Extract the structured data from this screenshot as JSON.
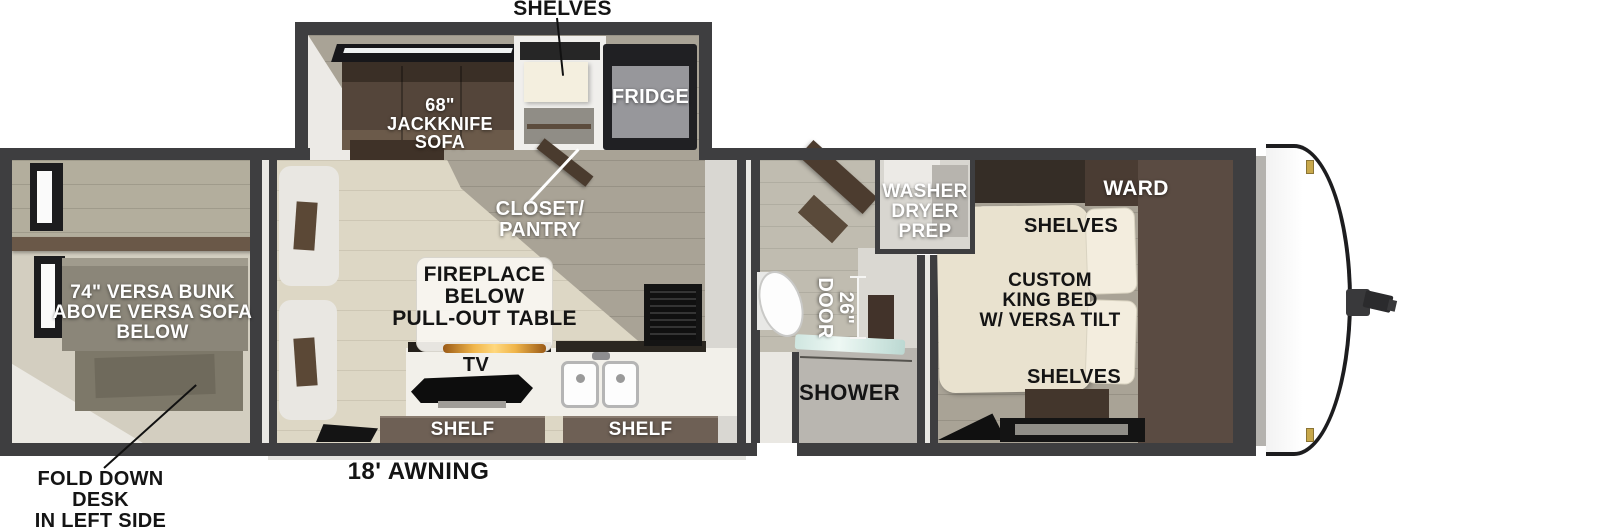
{
  "palette": {
    "wall": "#3e3e40",
    "floor_beige": "#ddd7c5",
    "floor_olive": "#a9a396",
    "sofa_brown": "#54453a",
    "ward_brown": "#5a4b42",
    "bed_cream": "#e9e2cf",
    "shelf_bar_brown": "#6e6055",
    "flame_orange": "#e09a36",
    "shower_glass_teal": "#cfe6e0",
    "marker_light_gold": "#c8a84b"
  },
  "floorplan": {
    "callouts": {
      "shelves_slideout": "SHELVES",
      "closet_pantry": "CLOSET/\nPANTRY",
      "fold_down_desk": "FOLD DOWN DESK\nIN LEFT SIDE\nREAR BED",
      "awning": "18' AWNING"
    },
    "slideout": {
      "sofa": "68\"\nJACKKNIFE\nSOFA",
      "fridge": "FRIDGE"
    },
    "rear_bedroom": {
      "bunk": "74\" VERSA BUNK\nABOVE VERSA SOFA\nBELOW"
    },
    "living_kitchen": {
      "fireplace_table": "FIREPLACE\nBELOW\nPULL-OUT TABLE",
      "tv": "TV",
      "shelf_left": "SHELF",
      "shelf_right": "SHELF"
    },
    "bathroom": {
      "washer_dryer_prep": "WASHER\nDRYER\nPREP",
      "door_width": "26\"\nDOOR",
      "shower": "SHOWER"
    },
    "front_bedroom": {
      "ward": "WARD",
      "shelves_top": "SHELVES",
      "bed": "CUSTOM\nKING BED\nW/ VERSA TILT",
      "shelves_bottom": "SHELVES"
    }
  }
}
